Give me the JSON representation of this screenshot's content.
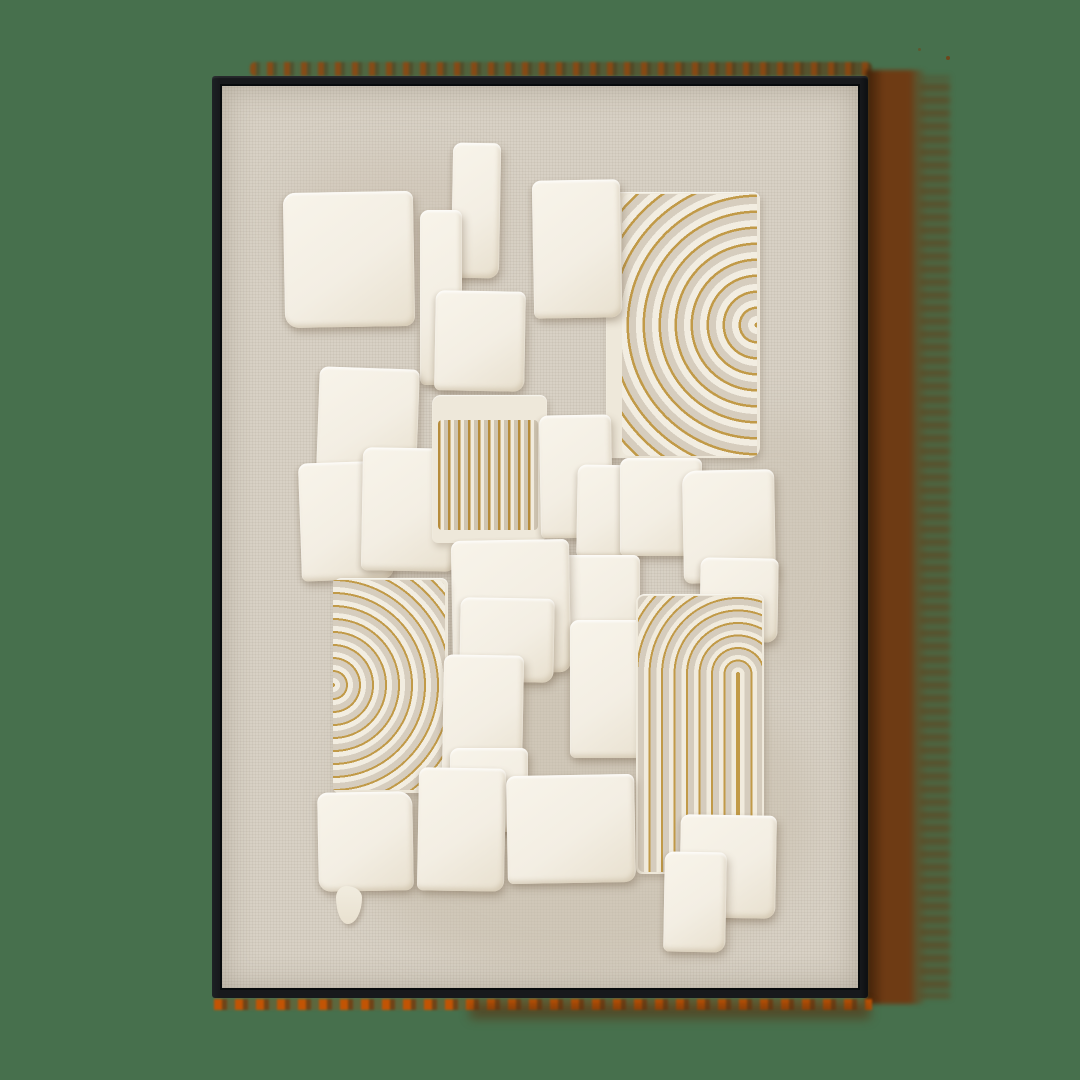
{
  "scene": {
    "type": "product-photo",
    "description": "Framed abstract textured artwork: white plaster squares and gold concentric arc motifs on natural linen canvas, thin black gallery frame, warm brown cast shadow with orange fringe, solid green backdrop",
    "palette": {
      "backdrop_green": "#47704d",
      "frame_black": "#17191c",
      "canvas_linen": "#d8d1c5",
      "plaster_white": "#f3eee3",
      "plaster_highlight": "#f8f4ea",
      "greige_groove": "#d6cdbe",
      "gold_leaf": "#c19a48",
      "shadow_brown": "#6e3b14",
      "shadow_orange": "#c25404"
    },
    "artwork": {
      "motifs": [
        "overlapping white plaster squares",
        "gold half-rings top right",
        "gold half-rings bottom left",
        "gold arches with vertical legs right middle",
        "gold vertical stripes center"
      ]
    }
  }
}
